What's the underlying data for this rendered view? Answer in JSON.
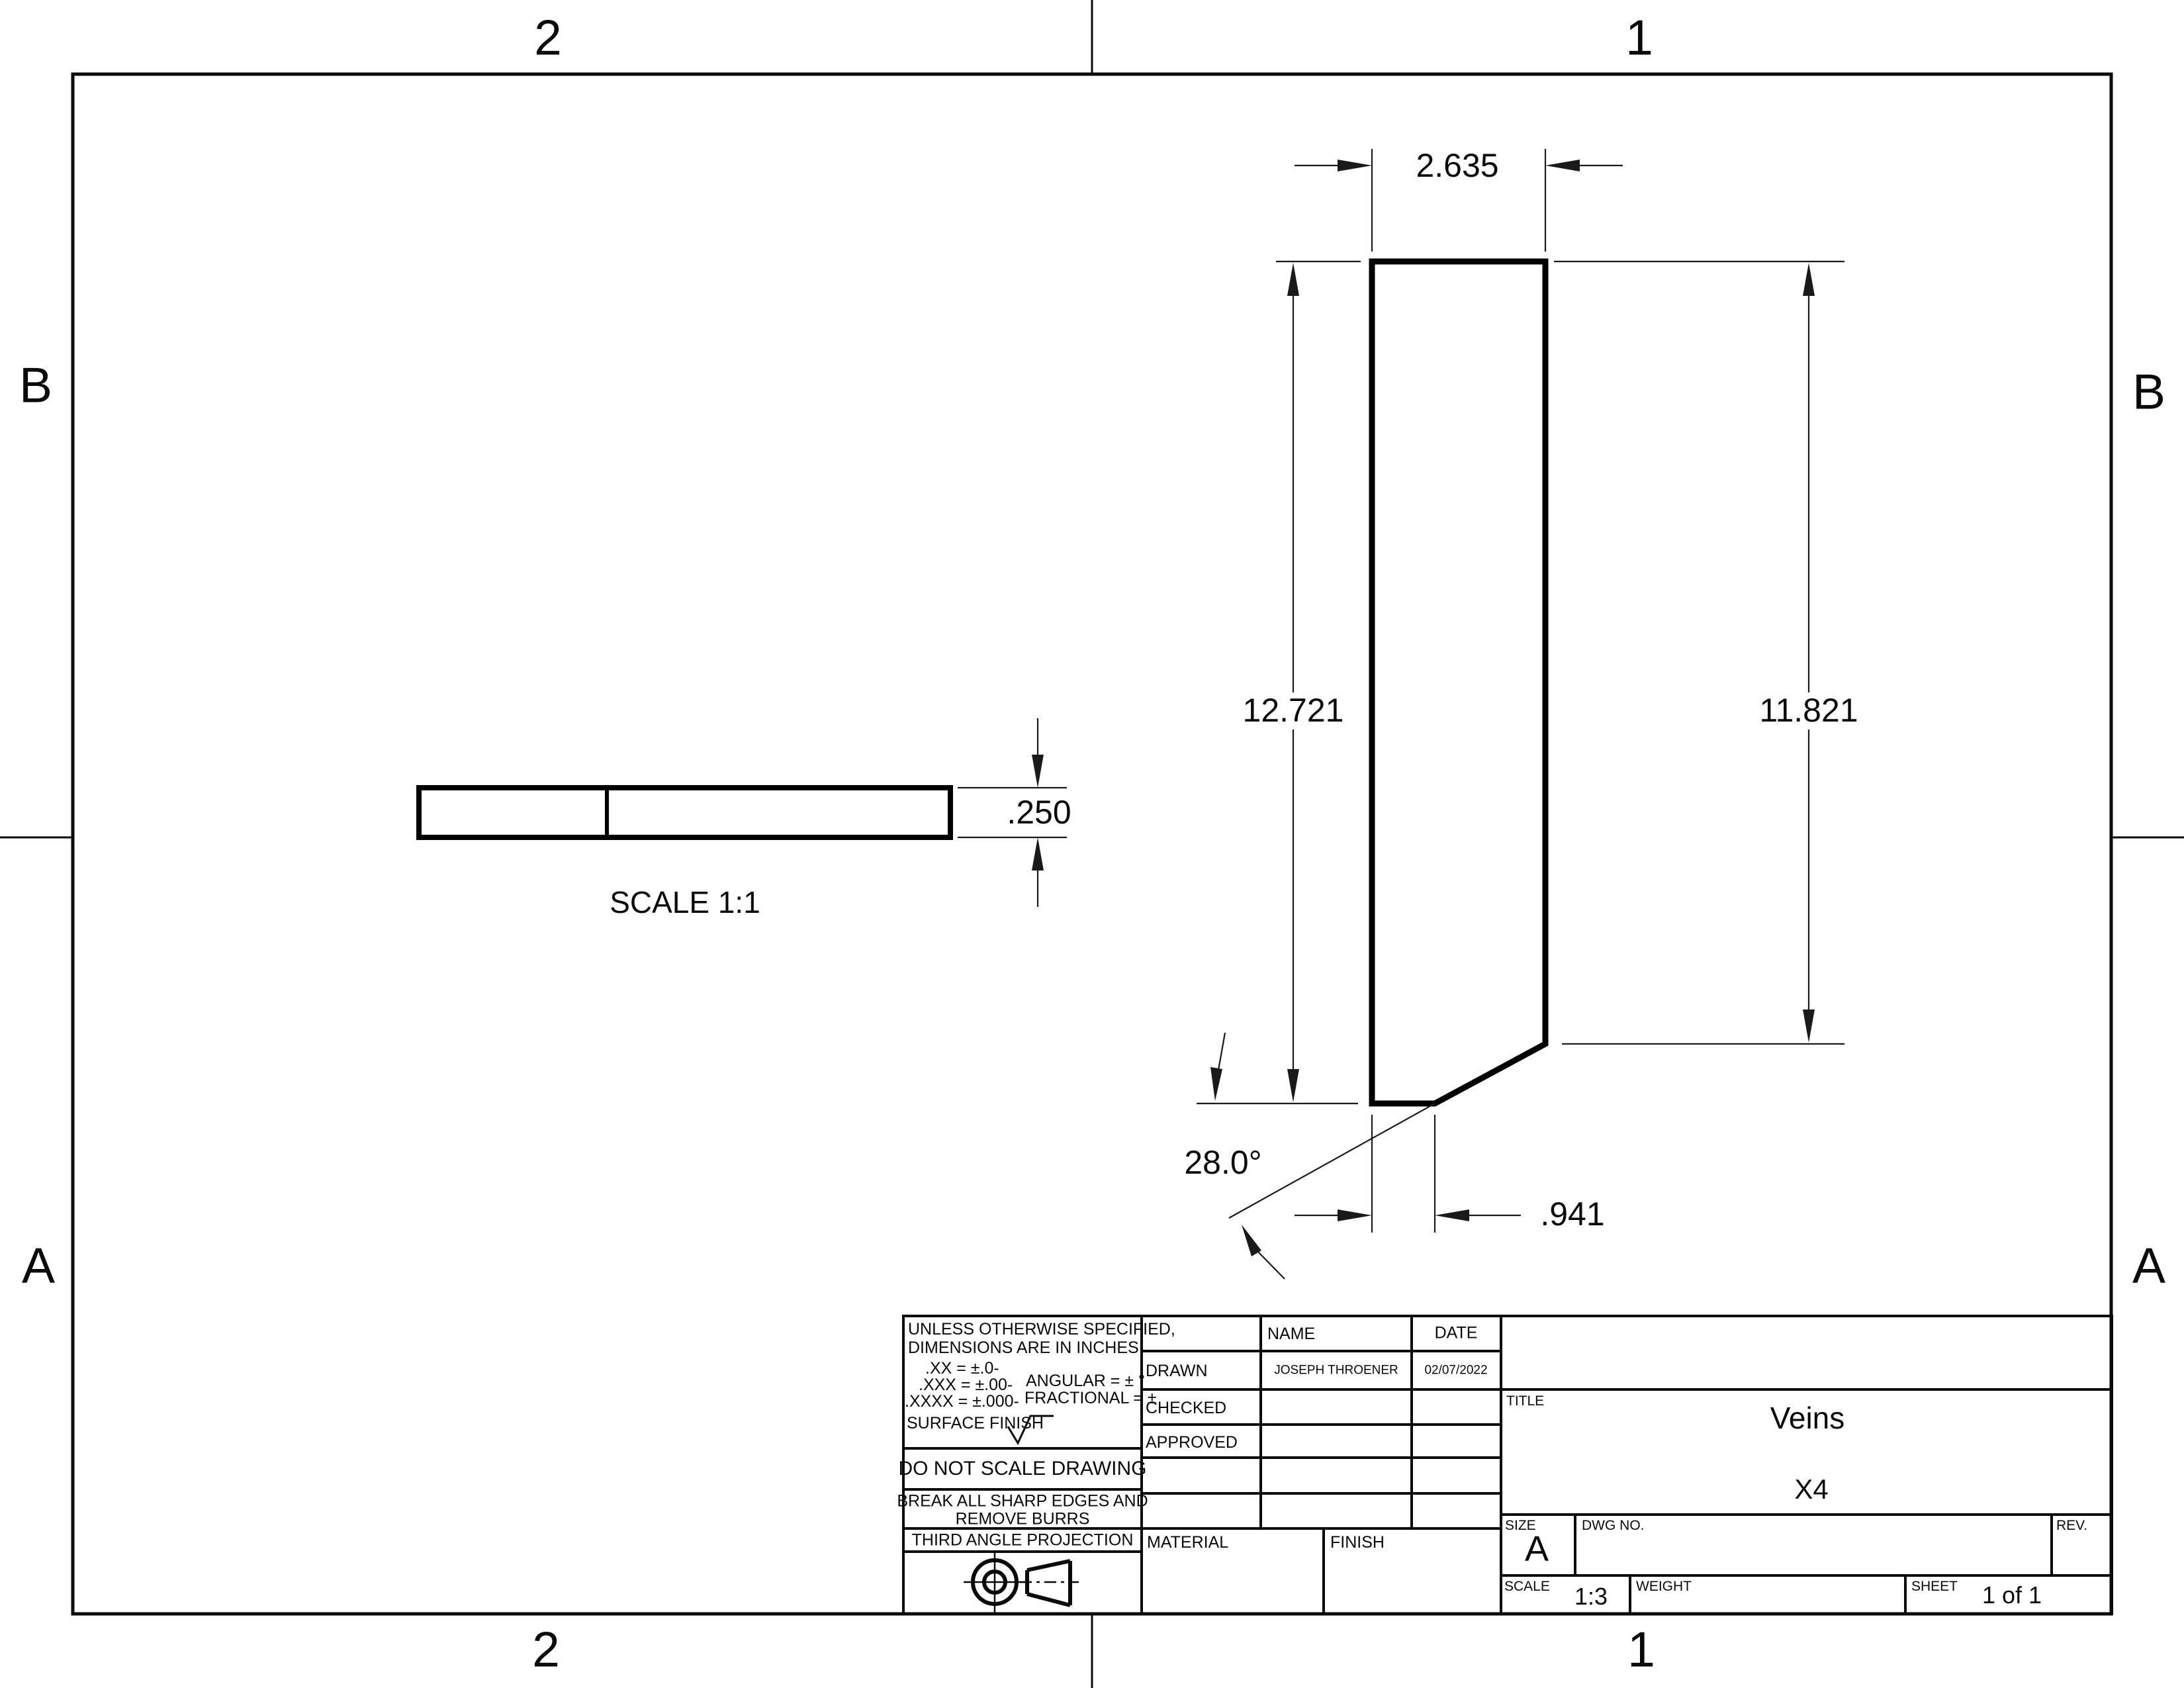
{
  "zones": {
    "top_left": "2",
    "top_right": "1",
    "bottom_left": "2",
    "bottom_right": "1",
    "left_upper": "B",
    "left_lower": "A",
    "right_upper": "B",
    "right_lower": "A"
  },
  "front_view": {
    "width": "2.635",
    "left_height": "12.721",
    "right_height": "11.821",
    "angle": "28.0°",
    "bottom_width": ".941"
  },
  "side_view": {
    "thickness": ".250",
    "scale_note": "SCALE 1:1"
  },
  "tb": {
    "note1": "UNLESS OTHERWISE SPECIFIED,",
    "note2": "DIMENSIONS ARE IN INCHES",
    "tol_xx": ".XX = ±.0-",
    "tol_xxx": ".XXX = ±.00-",
    "tol_xxxx": ".XXXX = ±.000-",
    "tol_angular": "ANGULAR = ± °",
    "tol_fractional": "FRACTIONAL = ±",
    "surface_finish": "SURFACE FINISH",
    "do_not_scale": "DO NOT SCALE DRAWING",
    "break1": "BREAK ALL SHARP EDGES AND",
    "break2": "REMOVE BURRS",
    "projection": "THIRD ANGLE PROJECTION",
    "name_h": "NAME",
    "date_h": "DATE",
    "rows": [
      {
        "label": "DRAWN",
        "name": "JOSEPH THROENER",
        "date": "02/07/2022"
      },
      {
        "label": "CHECKED",
        "name": "",
        "date": ""
      },
      {
        "label": "APPROVED",
        "name": "",
        "date": ""
      }
    ],
    "material_h": "MATERIAL",
    "finish_h": "FINISH",
    "title_h": "TITLE",
    "title": "Veins",
    "subtitle": "X4",
    "size_h": "SIZE",
    "size": "A",
    "dwg_h": "DWG NO.",
    "rev_h": "REV.",
    "scale_h": "SCALE",
    "scale": "1:3",
    "weight_h": "WEIGHT",
    "sheet_h": "SHEET",
    "sheet": "1 of 1"
  },
  "colors": {
    "ink": "#0a0a0a",
    "paper": "#ffffff"
  }
}
